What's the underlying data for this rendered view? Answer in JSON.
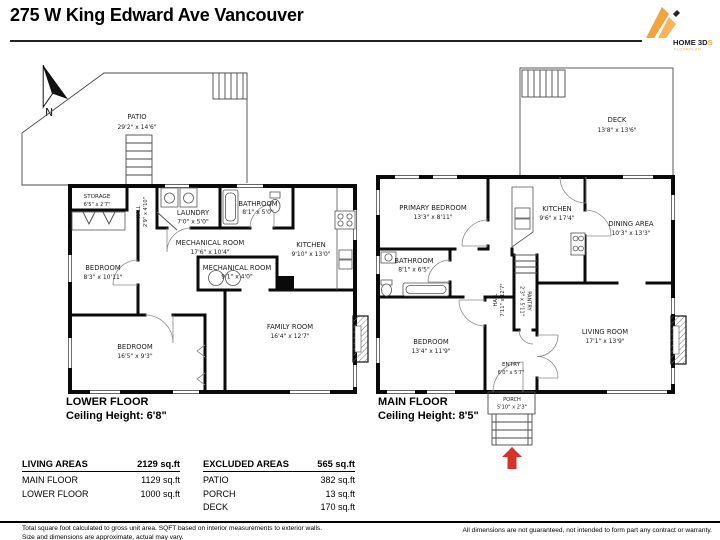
{
  "header": {
    "title": "275 W King Edward Ave Vancouver",
    "logo": {
      "name": "HOME 3D",
      "accent": "S",
      "subtitle": "FLOORPLAN",
      "color": "#F2A33C"
    }
  },
  "compass": {
    "label": "N"
  },
  "lower_floor": {
    "caption": "LOWER FLOOR",
    "ceiling": "Ceiling Height: 6'8\"",
    "rooms": {
      "patio": {
        "name": "PATIO",
        "dims": "29'2\" x 14'6\""
      },
      "storage": {
        "name": "STORAGE",
        "dims": "6'5\" x 2'7\""
      },
      "hall": {
        "name": "HALL",
        "dims": "2'9\" x 4'10\""
      },
      "laundry": {
        "name": "LAUNDRY",
        "dims": "7'0\" x 5'0\""
      },
      "bathroom": {
        "name": "BATHROOM",
        "dims": "8'1\" x 5'0\""
      },
      "mechanical1": {
        "name": "MECHANICAL ROOM",
        "dims": "17'6\" x 10'4\""
      },
      "mechanical2": {
        "name": "MECHANICAL ROOM",
        "dims": "9'1\" x 4'0\""
      },
      "kitchen": {
        "name": "KITCHEN",
        "dims": "9'10\" x 13'0\""
      },
      "bedroom1": {
        "name": "BEDROOM",
        "dims": "8'3\" x 10'11\""
      },
      "bedroom2": {
        "name": "BEDROOM",
        "dims": "16'5\" x 9'3\""
      },
      "family": {
        "name": "FAMILY ROOM",
        "dims": "16'4\" x 12'7\""
      }
    }
  },
  "main_floor": {
    "caption": "MAIN FLOOR",
    "ceiling": "Ceiling Height: 8'5\"",
    "rooms": {
      "deck": {
        "name": "DECK",
        "dims": "13'8\" x 13'6\""
      },
      "primary_bedroom": {
        "name": "PRIMARY BEDROOM",
        "dims": "13'3\" x 8'11\""
      },
      "kitchen": {
        "name": "KITCHEN",
        "dims": "9'6\" x 17'4\""
      },
      "dining": {
        "name": "DINING AREA",
        "dims": "10'3\" x 13'3\""
      },
      "bathroom": {
        "name": "BATHROOM",
        "dims": "8'1\" x 6'5\""
      },
      "hall": {
        "name": "HALL",
        "dims": "7'11\" x 12'7\""
      },
      "pantry": {
        "name": "PANTRY",
        "dims": "2'3\" x 5'11\""
      },
      "bedroom": {
        "name": "BEDROOM",
        "dims": "13'4\" x 11'9\""
      },
      "living": {
        "name": "LIVING ROOM",
        "dims": "17'1\" x 13'9\""
      },
      "entry": {
        "name": "ENTRY",
        "dims": "6'0\" x 5'7\""
      },
      "porch": {
        "name": "PORCH",
        "dims": "5'10\" x 2'3\""
      }
    }
  },
  "tables": {
    "living_areas": {
      "header": "LIVING AREAS",
      "total": "2129 sq.ft",
      "rows": [
        {
          "label": "MAIN FLOOR",
          "value": "1129 sq.ft"
        },
        {
          "label": "LOWER FLOOR",
          "value": "1000 sq.ft"
        }
      ]
    },
    "excluded_areas": {
      "header": "EXCLUDED AREAS",
      "total": "565 sq.ft",
      "rows": [
        {
          "label": "PATIO",
          "value": "382 sq.ft"
        },
        {
          "label": "PORCH",
          "value": "13 sq.ft"
        },
        {
          "label": "DECK",
          "value": "170 sq.ft"
        }
      ]
    }
  },
  "footer": {
    "left_line1": "Total square foot calculated to gross unit area. SQFT based on interior measurements to exterior walls.",
    "left_line2": "Size and dimensions are approximate, actual may vary.",
    "right": "All dimensions are not guaranteed, not intended to form part any contract or warranty."
  },
  "colors": {
    "entry_arrow": "#d3342b",
    "logo_orange": "#F2A33C"
  }
}
